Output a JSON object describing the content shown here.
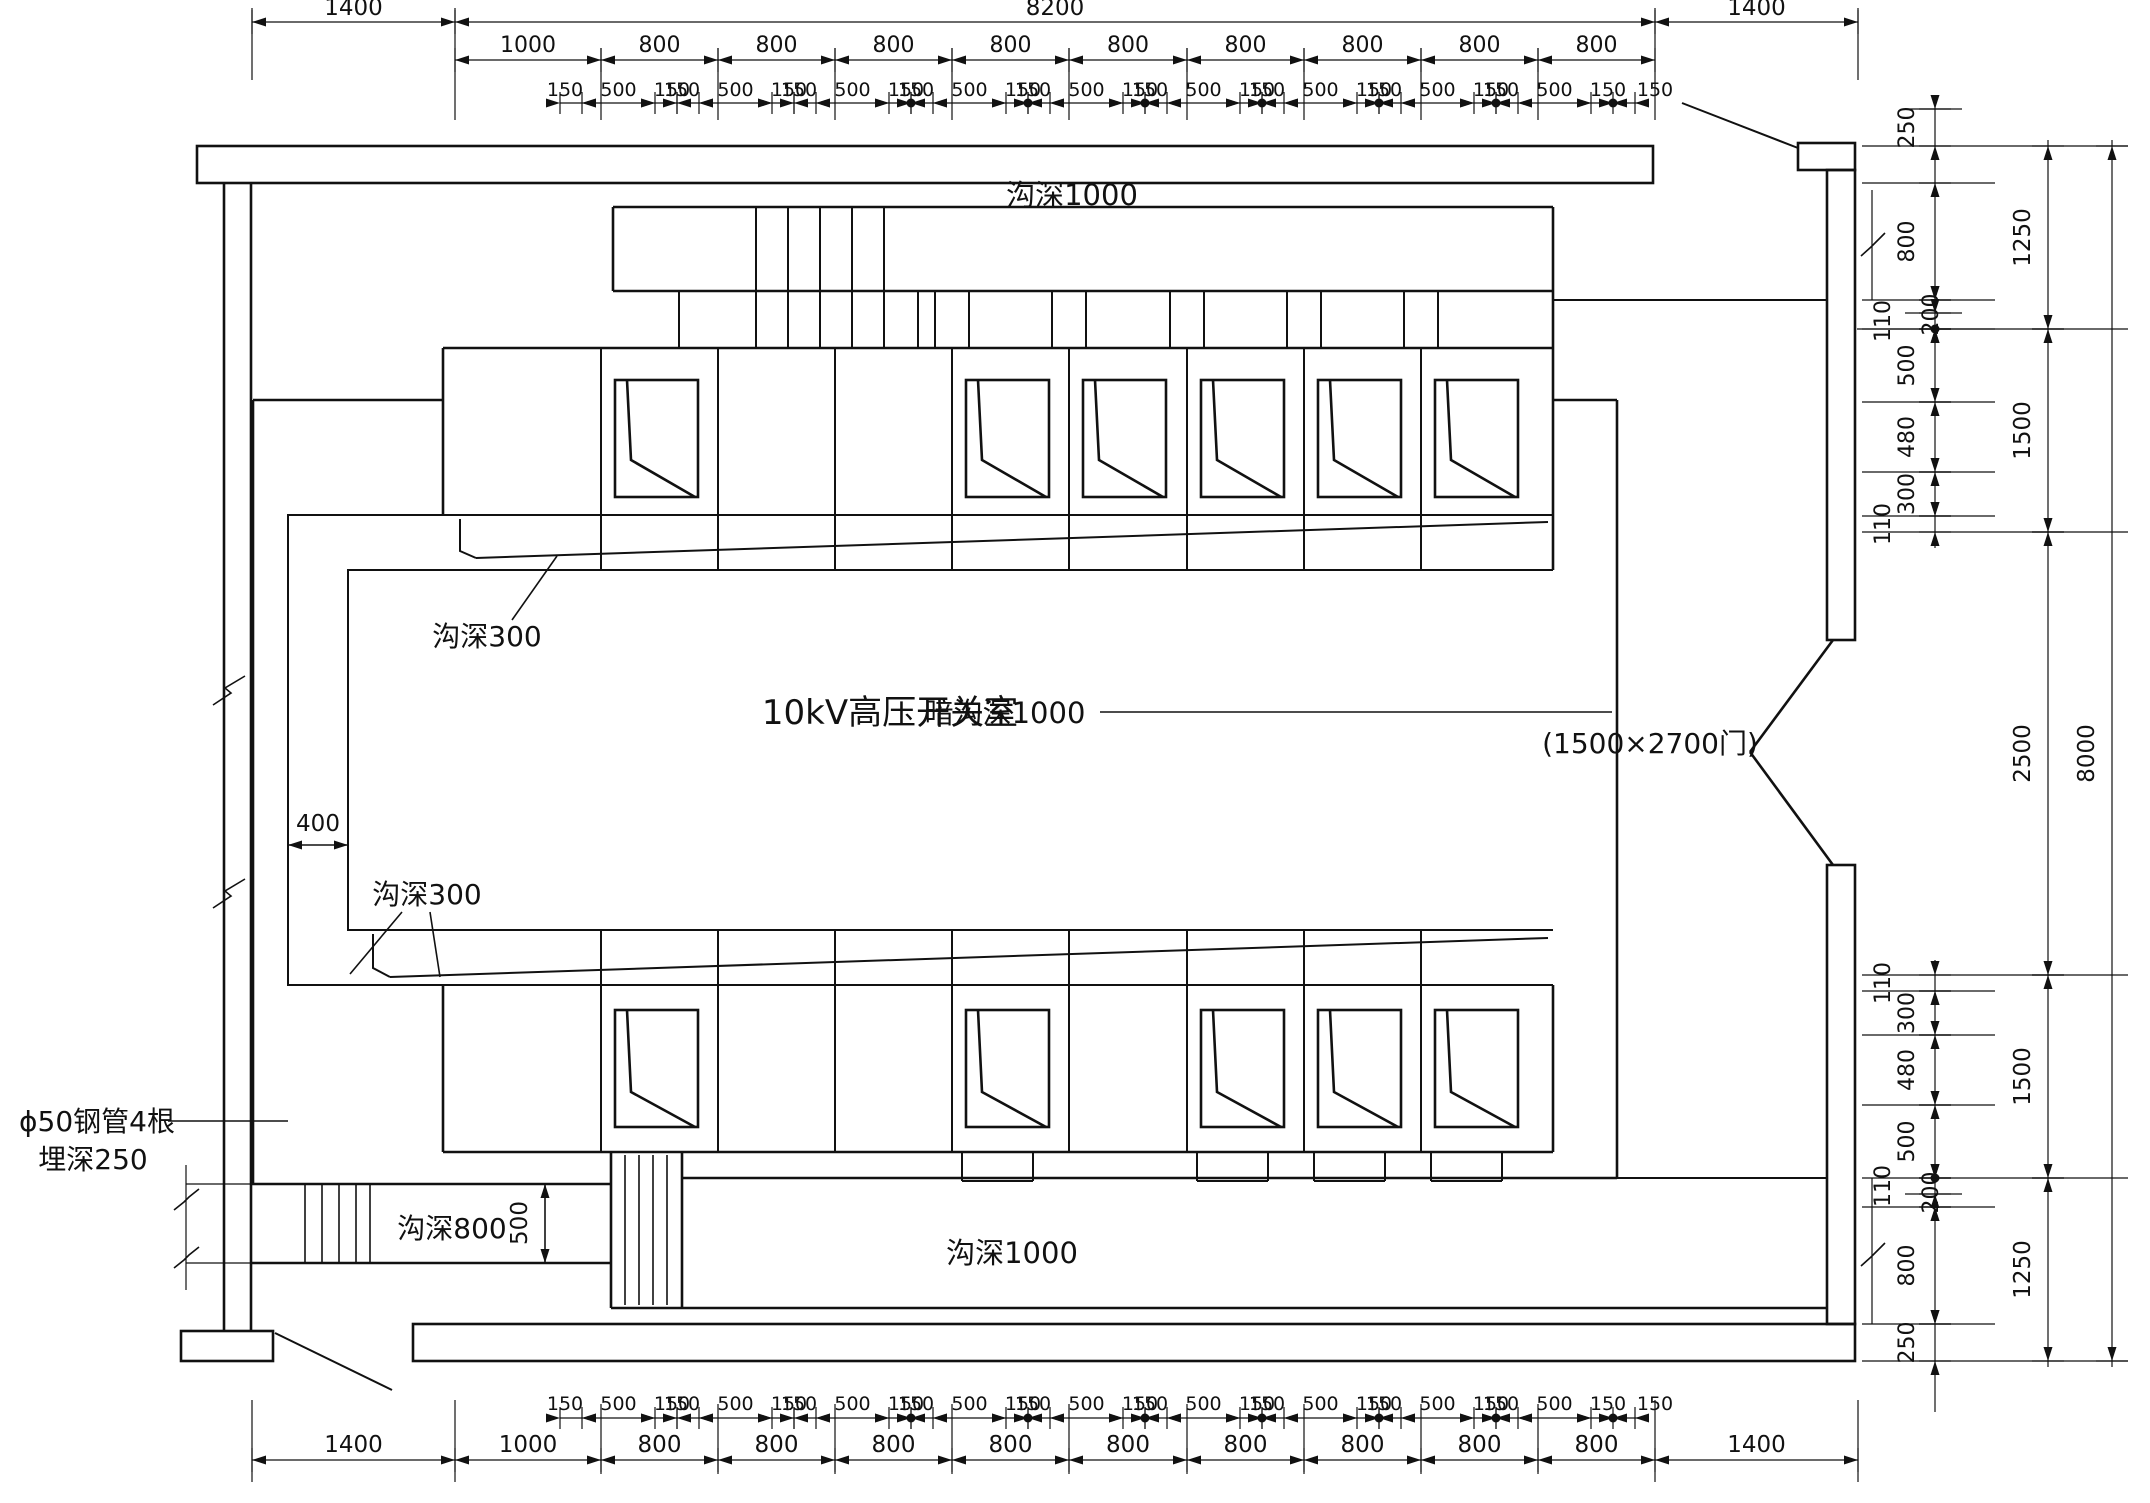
{
  "drawing": {
    "room_label": "10kV高压开关室",
    "door_label": "(1500×2700门)",
    "annotations": {
      "trench_top": "沟深1000",
      "trench_bottom": "沟深1000",
      "trench_hidden": "暗沟深1000",
      "trench_left": "沟深800",
      "shallow_trench_top": "沟深300",
      "shallow_trench_bottom": "沟深300",
      "pipes_line1": "ϕ50钢管4根",
      "pipes_line2": "埋深250",
      "duct_width": "400",
      "left_trench_depth": "500"
    },
    "dimensions": {
      "top_row1": [
        "1400",
        "8200",
        "1400"
      ],
      "top_row2": [
        "1000",
        "800",
        "800",
        "800",
        "800",
        "800",
        "800",
        "800",
        "800",
        "800"
      ],
      "sub_chain_group": [
        "150",
        "500",
        "150"
      ],
      "sub_chain_tail": "150",
      "sub_chain_repeats": 9,
      "bottom_row_main": [
        "1400",
        "1000",
        "800",
        "800",
        "800",
        "800",
        "800",
        "800",
        "800",
        "800",
        "800",
        "1400"
      ],
      "right_inner_top": [
        "250",
        "800",
        "110",
        "200",
        "500",
        "480",
        "300",
        "110"
      ],
      "right_inner_bottom": [
        "110",
        "300",
        "480",
        "500",
        "110",
        "200",
        "800",
        "250"
      ],
      "right_middle": [
        "1250",
        "1500",
        "2500",
        "1500",
        "1250"
      ],
      "right_outer": "8000"
    }
  }
}
